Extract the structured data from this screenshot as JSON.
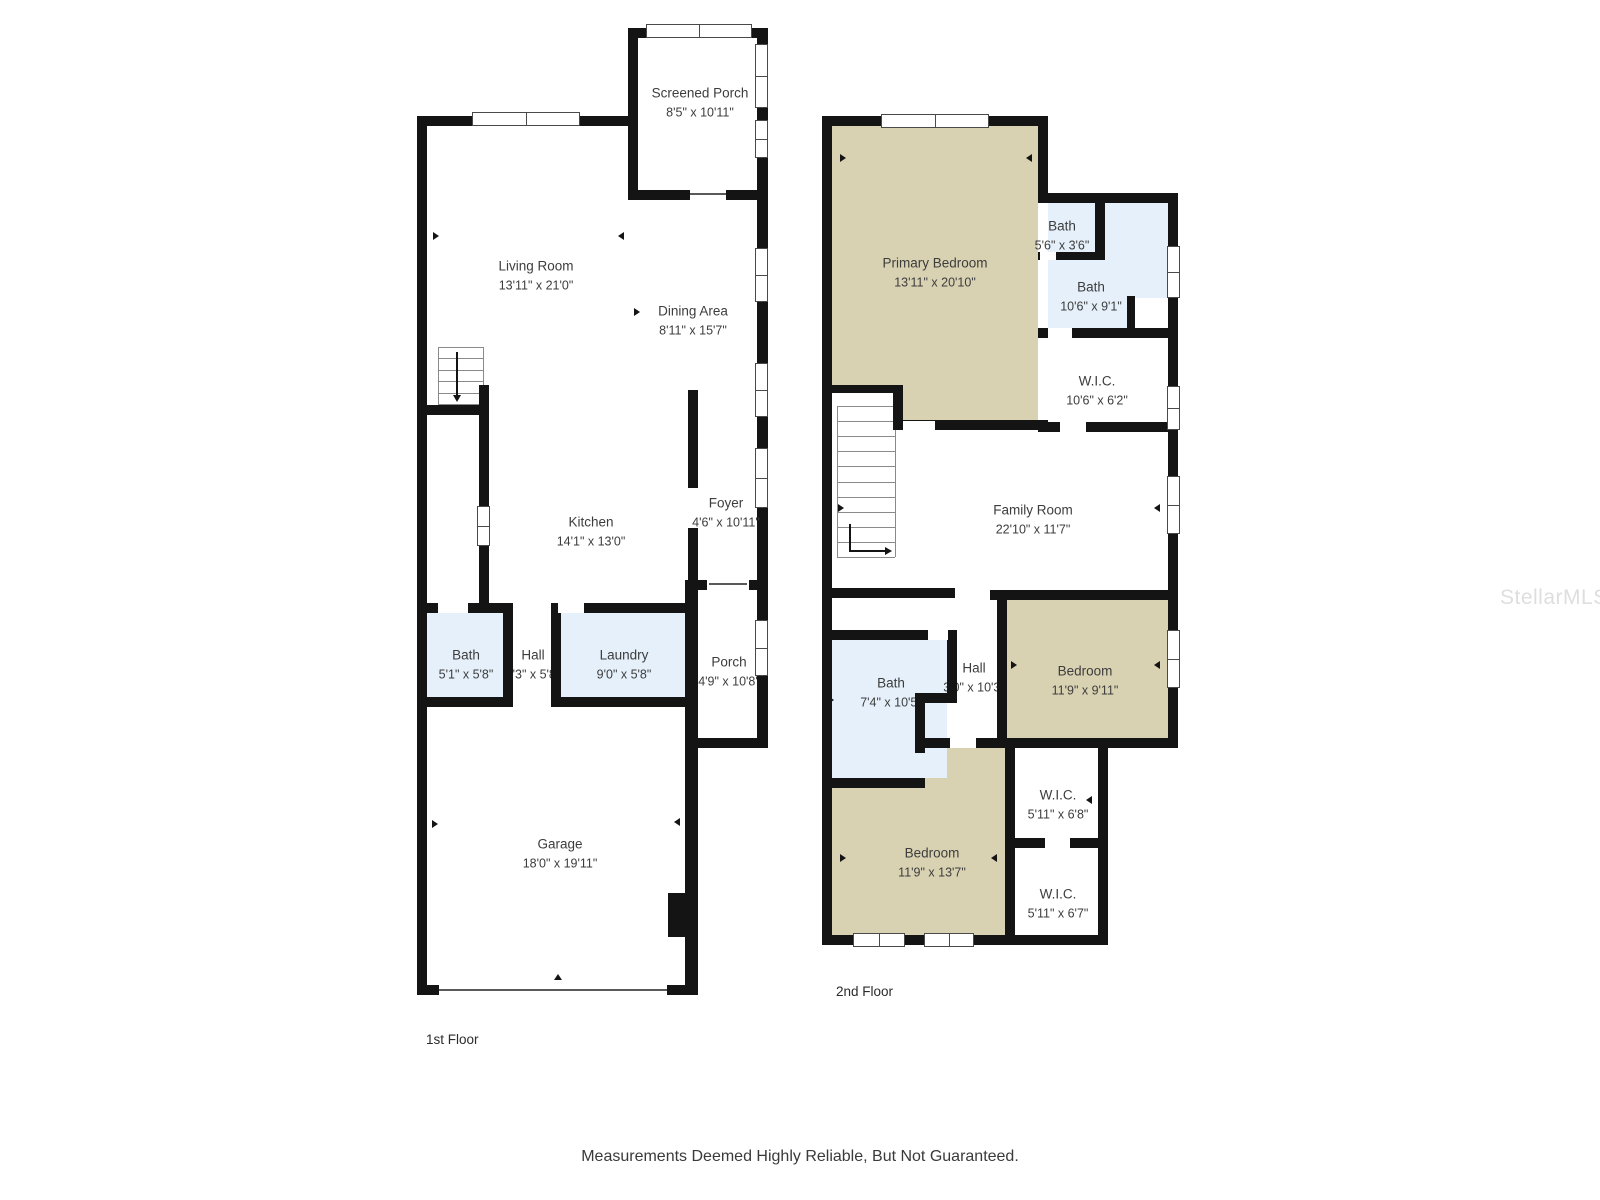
{
  "page": {
    "disclaimer": "Measurements Deemed Highly Reliable, But Not Guaranteed.",
    "watermark": "StellarMLS"
  },
  "colors": {
    "wall": "#141414",
    "room_tan": "#d8d1b2",
    "room_blue": "#e5f0fa",
    "room_white": "#ffffff",
    "label_text": "#3d3d3d"
  },
  "floor1": {
    "label": "1st Floor",
    "rooms": {
      "screened_porch": {
        "name": "Screened Porch",
        "dims": "8'5\" x 10'11\""
      },
      "living_room": {
        "name": "Living Room",
        "dims": "13'11\" x 21'0\""
      },
      "dining_area": {
        "name": "Dining Area",
        "dims": "8'11\" x 15'7\""
      },
      "kitchen": {
        "name": "Kitchen",
        "dims": "14'1\" x 13'0\""
      },
      "foyer": {
        "name": "Foyer",
        "dims": "4'6\" x 10'11\""
      },
      "bath": {
        "name": "Bath",
        "dims": "5'1\" x 5'8\""
      },
      "hall": {
        "name": "Hall",
        "dims": "3'3\" x 5'8\""
      },
      "laundry": {
        "name": "Laundry",
        "dims": "9'0\" x 5'8\""
      },
      "porch": {
        "name": "Porch",
        "dims": "4'9\" x 10'8\""
      },
      "garage": {
        "name": "Garage",
        "dims": "18'0\" x 19'11\""
      }
    }
  },
  "floor2": {
    "label": "2nd Floor",
    "rooms": {
      "primary_bedroom": {
        "name": "Primary Bedroom",
        "dims": "13'11\" x 20'10\""
      },
      "bath_small": {
        "name": "Bath",
        "dims": "5'6\" x 3'6\""
      },
      "bath_large": {
        "name": "Bath",
        "dims": "10'6\" x 9'1\""
      },
      "wic_1": {
        "name": "W.I.C.",
        "dims": "10'6\" x 6'2\""
      },
      "family_room": {
        "name": "Family Room",
        "dims": "22'10\" x 11'7\""
      },
      "bath_2": {
        "name": "Bath",
        "dims": "7'4\" x 10'5\""
      },
      "hall": {
        "name": "Hall",
        "dims": "3'0\" x 10'3\""
      },
      "bedroom_1": {
        "name": "Bedroom",
        "dims": "11'9\" x 9'11\""
      },
      "wic_2": {
        "name": "W.I.C.",
        "dims": "5'11\" x 6'8\""
      },
      "bedroom_2": {
        "name": "Bedroom",
        "dims": "11'9\" x 13'7\""
      },
      "wic_3": {
        "name": "W.I.C.",
        "dims": "5'11\" x 6'7\""
      }
    }
  }
}
